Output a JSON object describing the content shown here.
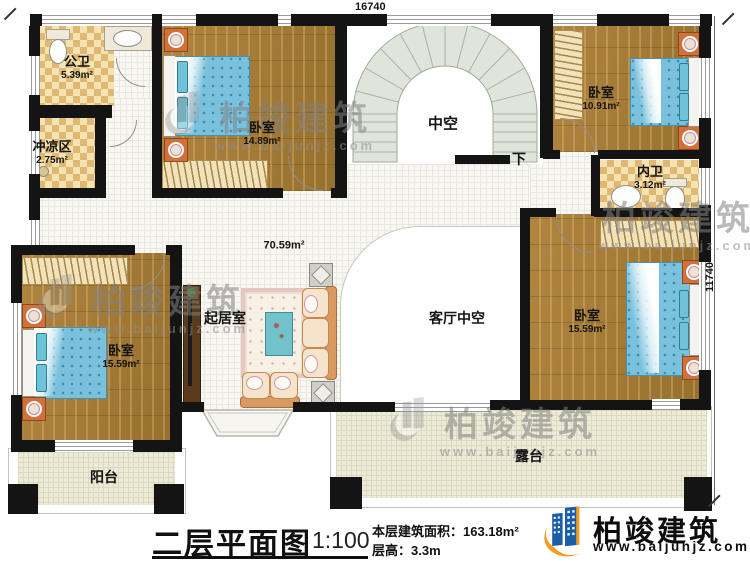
{
  "drawing": {
    "title": "二层平面图",
    "scale": "1:100",
    "floor_area_label": "本层建筑面积：163.18m²",
    "floor_height_label": "层高：3.3m"
  },
  "dimensions": {
    "top_width": "16740",
    "right_height": "11740"
  },
  "rooms": {
    "public_bath": {
      "name": "公卫",
      "area": "5.39m²"
    },
    "shower": {
      "name": "冲凉区",
      "area": "2.75m²"
    },
    "bedroom_top": {
      "name": "卧室",
      "area": "14.89m²"
    },
    "bedroom_top_right": {
      "name": "卧室",
      "area": "10.91m²"
    },
    "inner_bath": {
      "name": "内卫",
      "area": "3.12m²"
    },
    "bedroom_right": {
      "name": "卧室",
      "area": "15.59m²"
    },
    "bedroom_left": {
      "name": "卧室",
      "area": "15.59m²"
    },
    "living": {
      "name": "起居室",
      "area": "70.59m²"
    },
    "stair_void": {
      "name": "中空"
    },
    "stair_down": {
      "name": "下"
    },
    "living_void": {
      "name": "客厅中空"
    },
    "balcony": {
      "name": "阳台"
    },
    "terrace": {
      "name": "露台"
    }
  },
  "branding": {
    "company": "柏竣建筑",
    "website": "www.baijunjz.com"
  },
  "colors": {
    "wall": "#141414",
    "wood_floor": "#a67c3a",
    "checker_floor": "#f6e3b2",
    "tile_floor": "#f8f7f2",
    "outdoor_floor": "#edebd8",
    "bed": "#79c1dc",
    "stair": "#dfe5da",
    "logo_blue": "#1b5ea6",
    "logo_orange": "#f29b1d"
  }
}
